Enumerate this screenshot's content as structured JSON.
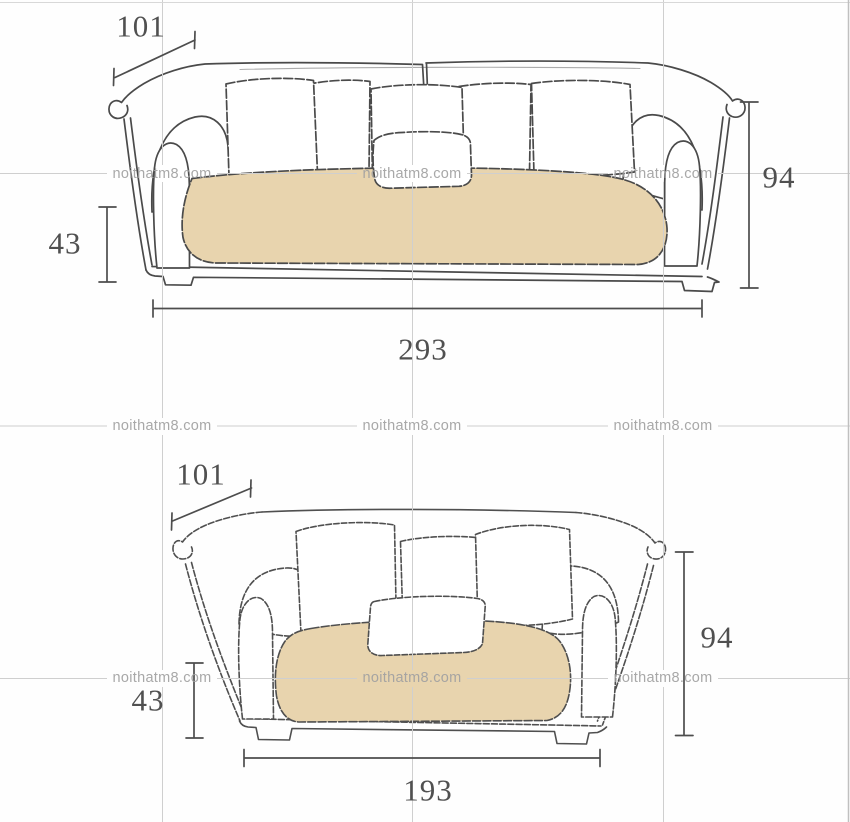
{
  "watermark": {
    "text": "noithatm8.com"
  },
  "colors": {
    "cushion_beige": "#e8d4ae",
    "sketch_line": "#4a4a4a",
    "grid_line": "#cfcfcf",
    "watermark_gray": "#a1a1a1",
    "dimension_text": "#505050"
  },
  "diagram": {
    "sofas": {
      "three_seater": {
        "back_pillow_count": 5,
        "dims": {
          "depth": "101",
          "seat_height": "43",
          "height": "94",
          "width": "293"
        }
      },
      "two_seater": {
        "back_pillow_count": 3,
        "dims": {
          "depth": "101",
          "seat_height": "43",
          "height": "94",
          "width": "193"
        }
      }
    }
  }
}
